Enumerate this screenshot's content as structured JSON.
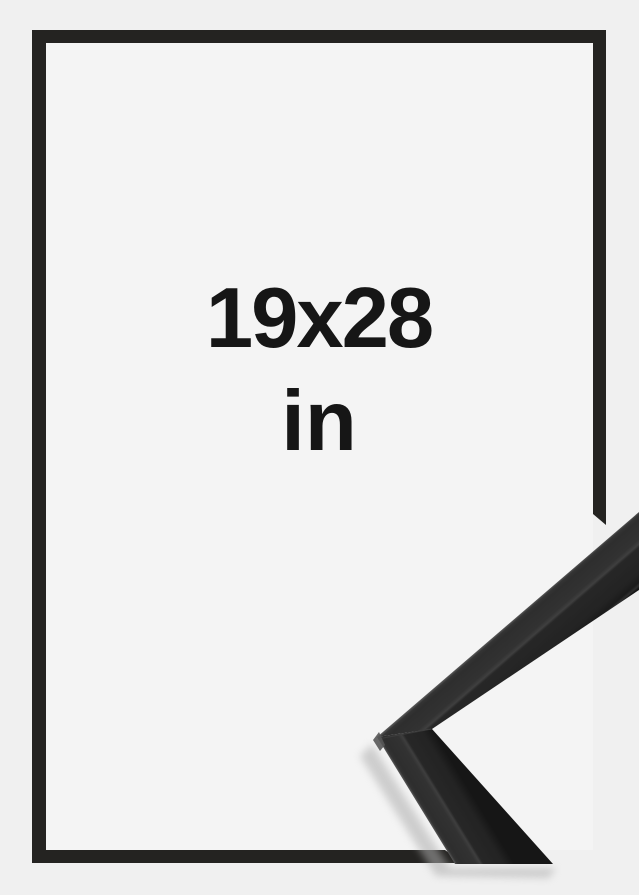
{
  "product": {
    "size_label": "19x28",
    "unit_label": "in"
  },
  "colors": {
    "page_background": "#f0f0f0",
    "frame_interior_background": "#f4f4f4",
    "frame_border": "#242321",
    "size_text": "#161616",
    "moulding_top_face": "#303030",
    "moulding_front_face": "#242424",
    "moulding_edge_highlight": "#555555",
    "moulding_shadow": "#b0b0b0"
  }
}
